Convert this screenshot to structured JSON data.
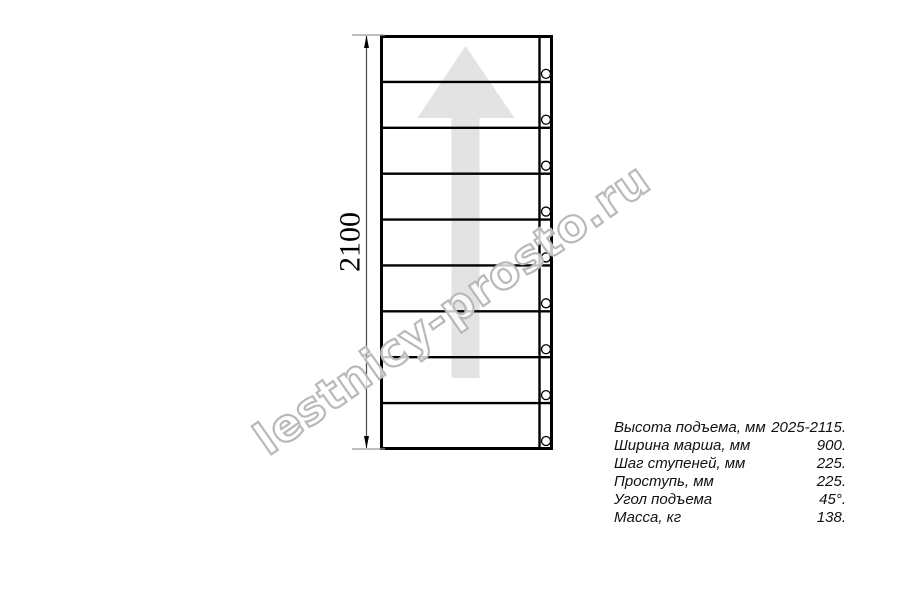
{
  "drawing": {
    "dimension_label": "2100",
    "watermark_text": "lestnicy-prosto.ru",
    "steps_count": 9,
    "bolt_holes_count": 9,
    "colors": {
      "line": "#000000",
      "arrow_fill": "#e3e3e3",
      "watermark_stroke": "#b9b9b9",
      "dimension_line": "#4a4a4a",
      "extension_line": "#999999"
    }
  },
  "specs": {
    "rows": [
      {
        "label": "Высота подъема, мм",
        "value": "2025-2115."
      },
      {
        "label": "Ширина марша, мм",
        "value": "900."
      },
      {
        "label": "Шаг ступеней, мм",
        "value": "225."
      },
      {
        "label": "Проступь, мм",
        "value": "225."
      },
      {
        "label": "Угол подъема",
        "value": "45°."
      },
      {
        "label": "Масса, кг",
        "value": "138."
      }
    ]
  }
}
